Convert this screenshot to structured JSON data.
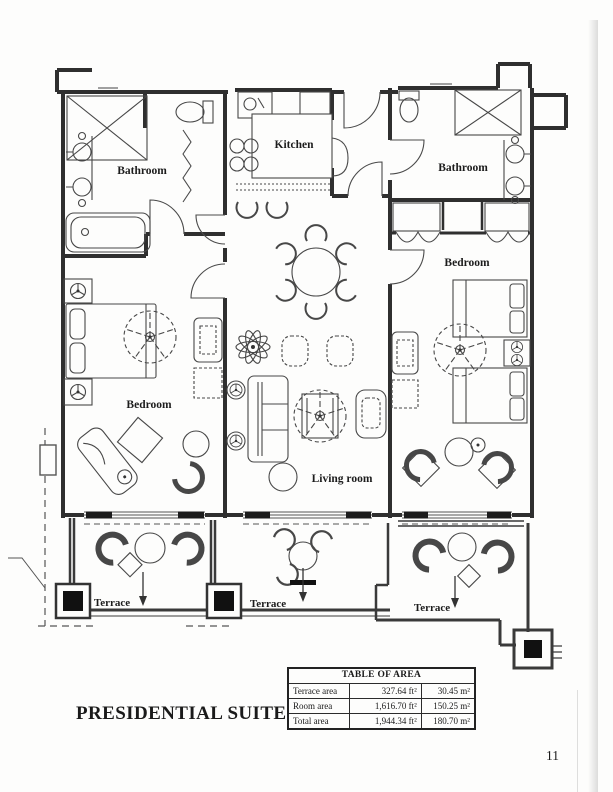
{
  "page": {
    "title": "PRESIDENTIAL SUITE",
    "page_number": "11"
  },
  "plan": {
    "rooms": {
      "bathroom_left": "Bathroom",
      "kitchen": "Kitchen",
      "bathroom_right": "Bathroom",
      "bedroom_left": "Bedroom",
      "living_room": "Living room",
      "bedroom_right": "Bedroom",
      "terrace_left": "Terrace",
      "terrace_middle": "Terrace",
      "terrace_right": "Terrace"
    },
    "icons": [
      "ceiling-fan-icon",
      "terrace-arrow-icon",
      "column-marker",
      "plant-icon"
    ]
  },
  "area_table": {
    "title": "TABLE OF AREA",
    "rows": [
      {
        "label": "Terrace area",
        "ft": "327.64 ft²",
        "m": "30.45 m²"
      },
      {
        "label": "Room area",
        "ft": "1,616.70 ft²",
        "m": "150.25 m²"
      },
      {
        "label": "Total area",
        "ft": "1,944.34 ft²",
        "m": "180.70 m²"
      }
    ]
  },
  "colors": {
    "ink": "#2f2f2f",
    "furniture": "#474747",
    "paper": "#fdfdfc"
  }
}
